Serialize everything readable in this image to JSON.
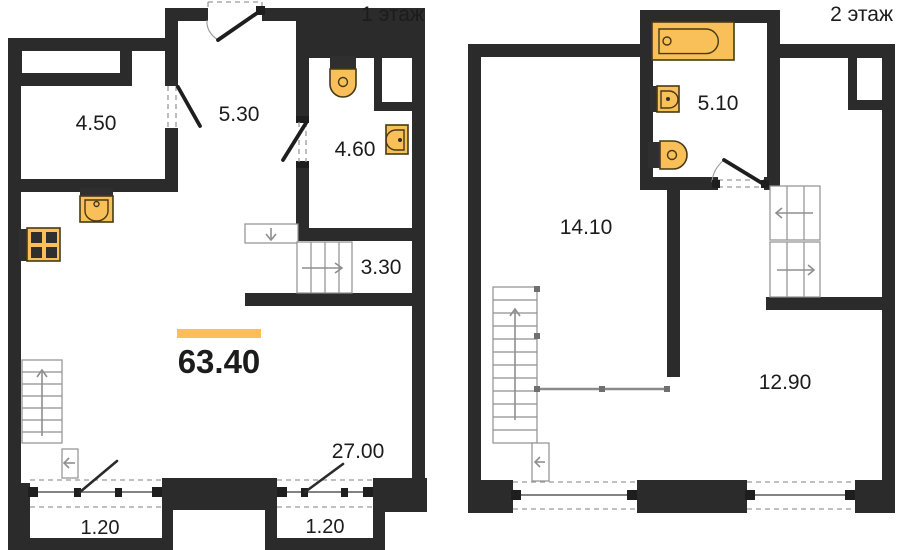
{
  "colors": {
    "wall": "#2b2b2b",
    "fixture": "#f9bf58",
    "fixture_stroke": "#463a15",
    "accent": "#fbbf55",
    "thin_line": "#8f8f8f",
    "dash_line": "#9a9a9a",
    "text": "#1c1c1c",
    "background": "#ffffff"
  },
  "floor1": {
    "title": "1 этаж",
    "total_area": "63.40",
    "rooms": {
      "storage": "4.50",
      "hallway": "5.30",
      "bathroom": "4.60",
      "stair_hall": "3.30",
      "living_kitchen": "27.00",
      "balcony_left": "1.20",
      "balcony_right": "1.20"
    },
    "fixtures": [
      "kitchen-sink",
      "stove",
      "toilet",
      "washbasin"
    ]
  },
  "floor2": {
    "title": "2 этаж",
    "rooms": {
      "bathroom": "5.10",
      "hall": "14.10",
      "bedroom": "12.90"
    },
    "fixtures": [
      "bathtub",
      "washbasin",
      "toilet"
    ]
  }
}
